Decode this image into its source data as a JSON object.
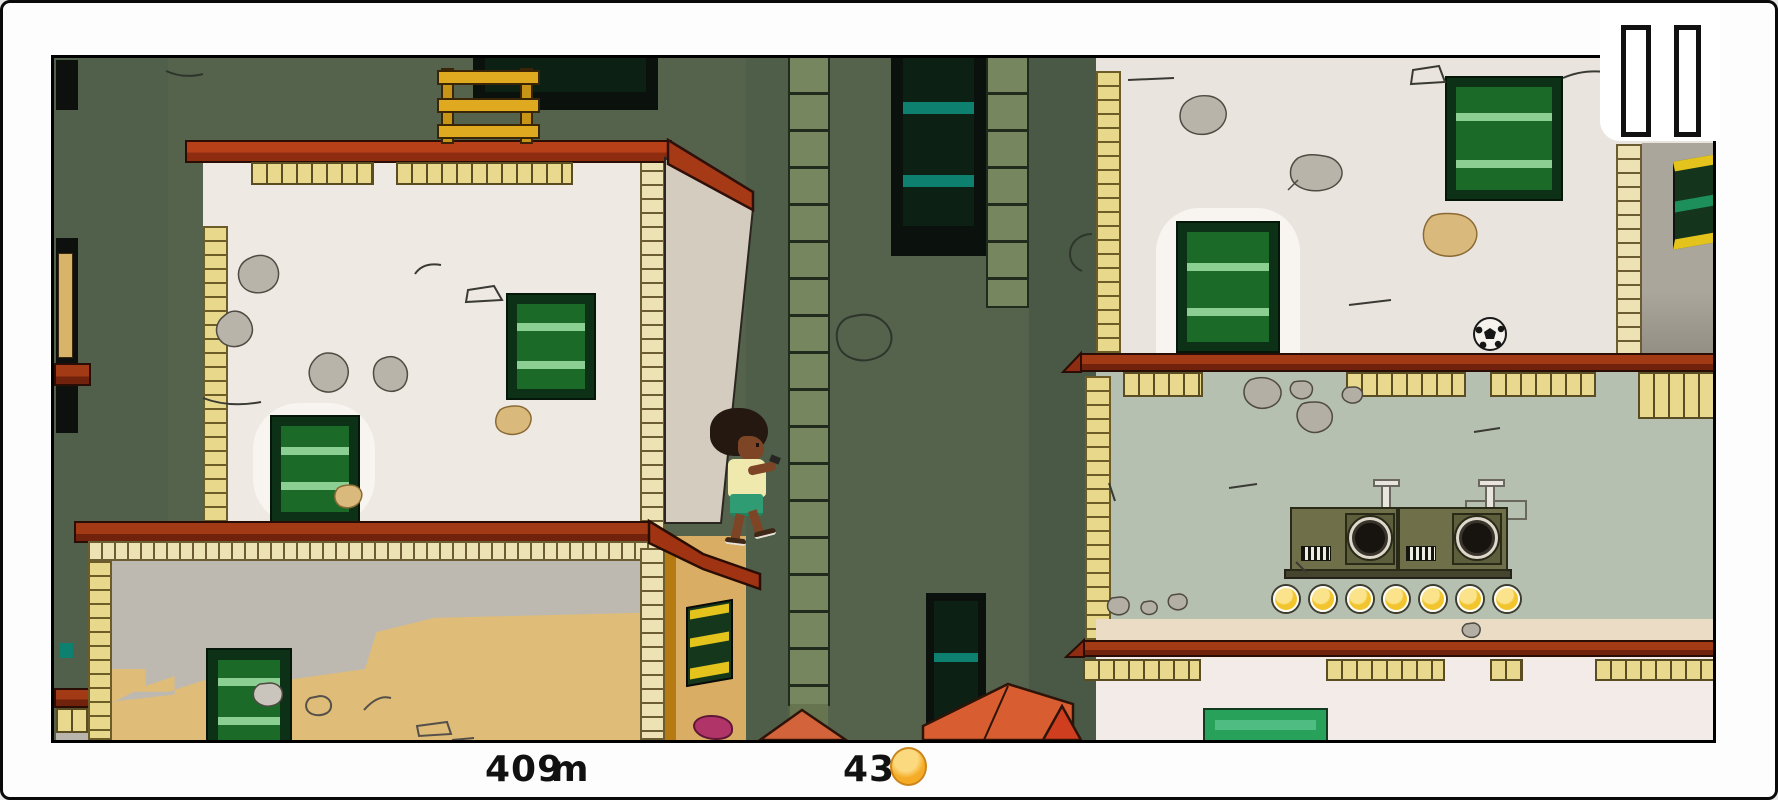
{
  "hud": {
    "distance": {
      "value": "409",
      "unit": "m"
    },
    "coins": {
      "count_label": "43",
      "icon": "coin-icon"
    }
  },
  "pause_button": {
    "icon": "pause-icon",
    "bar_count": 2
  },
  "scene": {
    "coin_row": {
      "count": 7
    },
    "character": "kid-with-afro-holding-phone",
    "objects": [
      "left-building",
      "right-building",
      "alley-background",
      "wooden-ladder",
      "soccer-ball",
      "speaker-machine",
      "orange-rooftops"
    ],
    "colors": {
      "background_green": "#55624c",
      "wall_white": "#efe9e4",
      "wall_sage": "#b6c0b1",
      "wall_tan": "#deb973",
      "ledge_red": "#8e2d11",
      "roof_red": "#a73a16",
      "brick_yellow": "#e7d88c",
      "window_green": "#1c6a28",
      "window_bar_green": "#8bd092",
      "machine_olive": "#6f7049",
      "coin_gold": "#f2c52e",
      "hud_text": "#111111"
    }
  }
}
